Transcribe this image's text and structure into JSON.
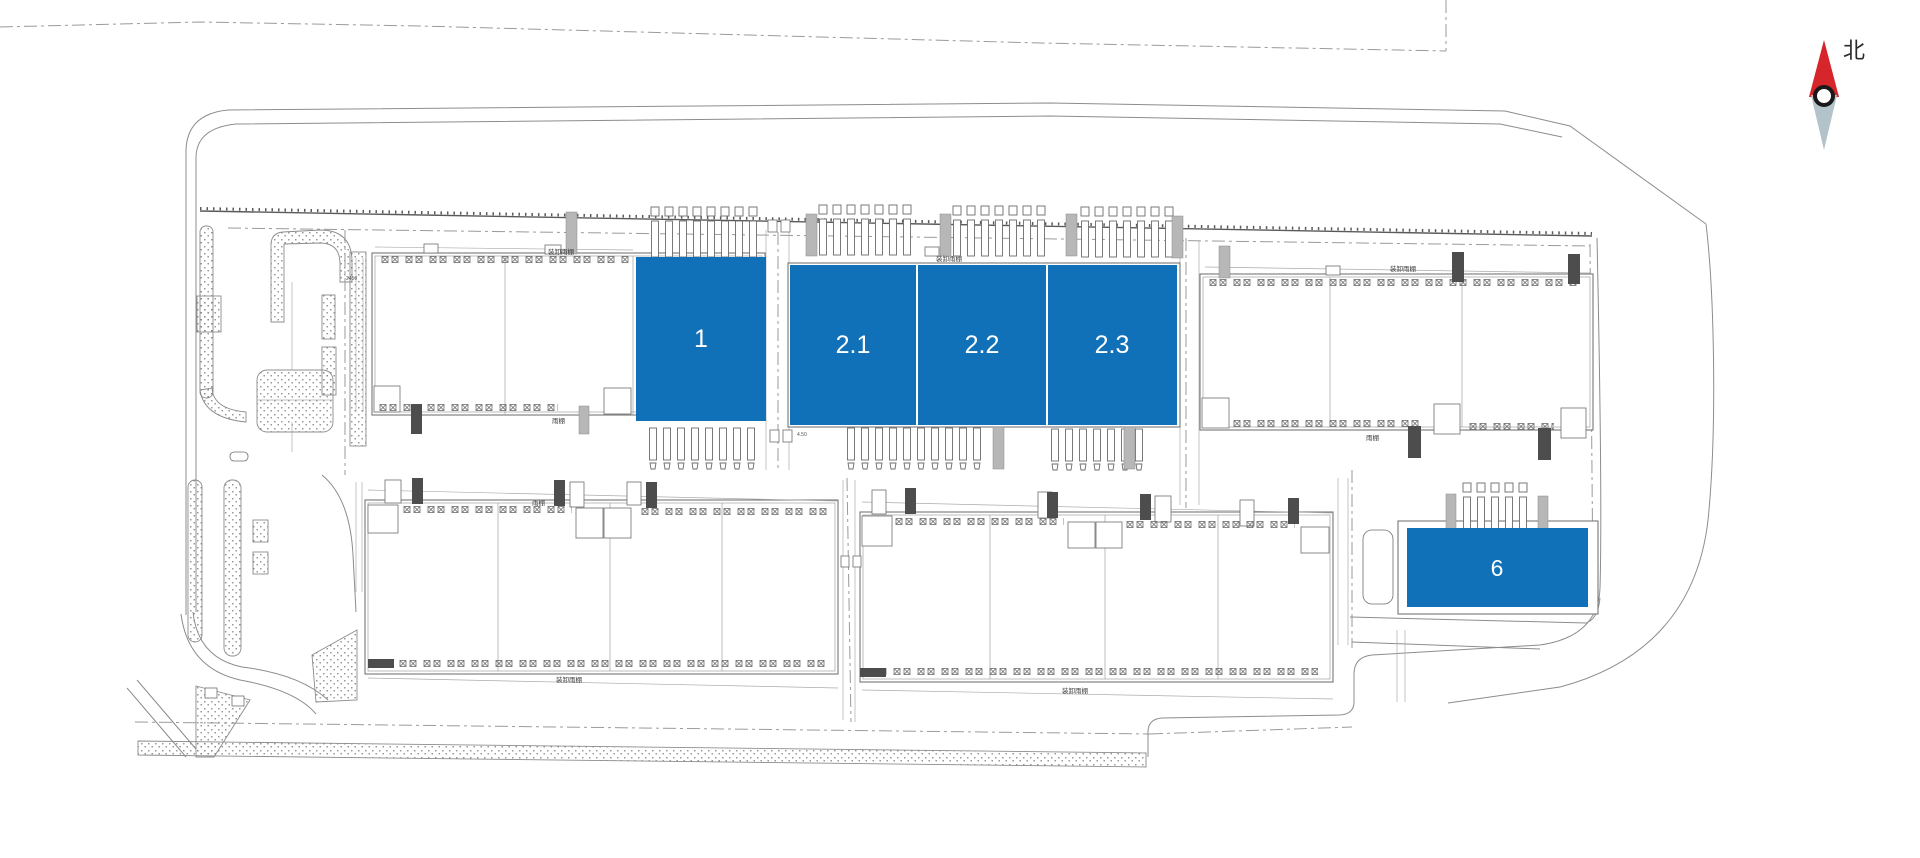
{
  "canvas": {
    "width": 1920,
    "height": 858,
    "background": "#ffffff"
  },
  "plan": {
    "description": "industrial park site plan with highlighted leasable units",
    "line_color": "#8c8c8c"
  },
  "units": {
    "color": "#1070b8",
    "label_color": "#ffffff",
    "items": [
      {
        "id": "1",
        "label": "1"
      },
      {
        "id": "2.1",
        "label": "2.1"
      },
      {
        "id": "2.2",
        "label": "2.2"
      },
      {
        "id": "2.3",
        "label": "2.3"
      },
      {
        "id": "6",
        "label": "6"
      }
    ]
  },
  "annotations": {
    "loading_canopy": "装卸雨棚",
    "canopy": "雨棚",
    "dim_a": "2450",
    "dim_b": "4.50"
  },
  "compass": {
    "label": "北",
    "needle_north_color": "#d6252b",
    "needle_south_color": "#b3c3ca",
    "ring_color": "#1a1a1a"
  }
}
